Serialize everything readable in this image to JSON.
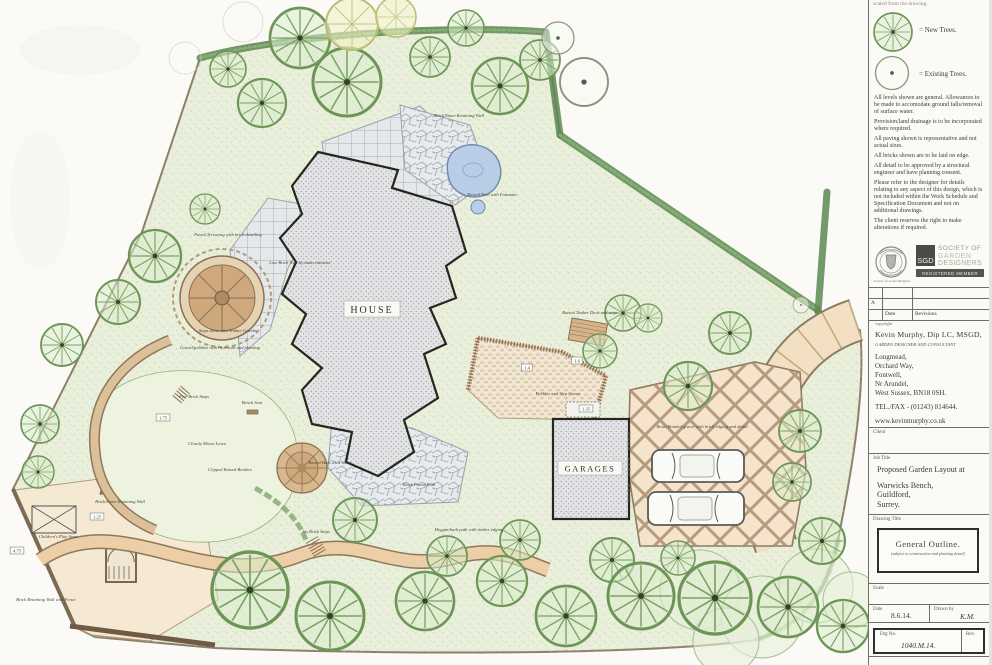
{
  "title_block": {
    "note_top": "scaled from the drawing.",
    "legend": [
      {
        "symbol": "new-tree-symbol",
        "label": "= New Trees."
      },
      {
        "symbol": "existing-tree-symbol",
        "label": "= Existing Trees."
      }
    ],
    "notes": [
      "All levels shown are general. Allowances to be made to accomodate ground falls/removal of surface water.",
      "Provision/land drainage is to be incorporated where required.",
      "All paving shown is representative and not actual sizes.",
      "All bricks shown are to be laid on edge.",
      "All detail to be approved by a structural engineer and have planning consent.",
      "Please refer to the designer for details relating to any aspect of this design, which is not included within the Work Schedule and Specification Document and not on additional drawings.",
      "The client reserves the right to make alterations if required."
    ],
    "sgd": {
      "abbr": "SGD",
      "line1": "SOCIETY OF",
      "line2": "GARDEN",
      "line3": "DESIGNERS",
      "member_bar": "REGISTERED MEMBER",
      "crest_caption": "Society of Garden Designers"
    },
    "revisions": {
      "marker": "A",
      "date_col": "Date",
      "revisions_col": "Revisions"
    },
    "copyright_label": "copyright",
    "designer": {
      "name": "Kevin Murphy, Dip LC, MSGD,",
      "role": "GARDEN DESIGNER AND CONSULTANT",
      "address": [
        "Longmead,",
        "Orchard Way,",
        "Fontwell,",
        "Nr Arundel,",
        "West Sussex, BN18 0SH."
      ],
      "tel": "TEL./FAX - (01243) 814644.",
      "web": "www.kevinmurphy.co.uk"
    },
    "client_label": "Client",
    "job_title_label": "Job Title",
    "job_title_lines": [
      "Proposed Garden Layout at",
      "Warwicks Bench,",
      "Guildford,",
      "Surrey."
    ],
    "drawing_title_label": "Drawing Title",
    "drawing_title": "General Outline.",
    "drawing_subtitle": "(subject to construction and planting detail)",
    "scale_label": "Scale",
    "date_label": "Date",
    "date_value": "8.6.14.",
    "drawn_by_label": "Drawn by",
    "drawn_by_value": "K.M.",
    "drg_no_label": "Drg No.",
    "drg_no_value": "1040.M.14.",
    "rev_label": "Rev."
  },
  "plan": {
    "house_label": "HOUSE",
    "garages_label": "GARAGES",
    "annotations": [
      {
        "text": "Brick/Stone Retaining Wall",
        "x": 459,
        "y": 117
      },
      {
        "text": "Raised Pool with Fountain",
        "x": 492,
        "y": 196
      },
      {
        "text": "Paved Terracing with brick detailing",
        "x": 228,
        "y": 236
      },
      {
        "text": "Low Brick Wall by main entrance",
        "x": 300,
        "y": 264
      },
      {
        "text": "Steps down into Timber Gazebo",
        "x": 228,
        "y": 332
      },
      {
        "text": "Gravel/pebbles with rockwork and planting",
        "x": 220,
        "y": 349
      },
      {
        "text": "Five Brick Steps",
        "x": 194,
        "y": 398
      },
      {
        "text": "Bench Seat",
        "x": 252,
        "y": 404
      },
      {
        "text": "Closely Mown Lawn",
        "x": 207,
        "y": 445
      },
      {
        "text": "Clipped Raised Borders",
        "x": 230,
        "y": 471
      },
      {
        "text": "Brick/Stone Retaining Wall",
        "x": 120,
        "y": 503
      },
      {
        "text": "Children's Play Area",
        "x": 58,
        "y": 538
      },
      {
        "text": "Brick Retaining Wall with Fence",
        "x": 46,
        "y": 601
      },
      {
        "text": "Six Brick Steps",
        "x": 316,
        "y": 533
      },
      {
        "text": "Hoggin/bark path with timber edging",
        "x": 469,
        "y": 531
      },
      {
        "text": "Resin Bonded gravel with brick edging and detail",
        "x": 702,
        "y": 428
      },
      {
        "text": "Raised Timber Deck and steps",
        "x": 590,
        "y": 314
      },
      {
        "text": "Pebbles and Step Stones",
        "x": 558,
        "y": 395
      },
      {
        "text": "Raised Beds with Water",
        "x": 330,
        "y": 464
      },
      {
        "text": "Brick Paved Path",
        "x": 419,
        "y": 486
      }
    ],
    "levels": [
      {
        "text": "1.75",
        "x": 163,
        "y": 418
      },
      {
        "text": "4.75",
        "x": 17,
        "y": 551
      },
      {
        "text": "1.25",
        "x": 97,
        "y": 517
      },
      {
        "text": "1.4",
        "x": 527,
        "y": 368
      },
      {
        "text": "1.6",
        "x": 577,
        "y": 361
      },
      {
        "text": "1.35",
        "x": 586,
        "y": 409
      }
    ]
  },
  "colors": {
    "paper": "#fbfaf6",
    "site_green": "#e9efdb",
    "hedge_green": "#5c8752",
    "paving_gray": "#e4e8ea",
    "brick_brown": "#9c7257",
    "drive_tan": "#f5e4cb",
    "pond_blue": "#b9cde6",
    "ink": "#3a3b36"
  }
}
